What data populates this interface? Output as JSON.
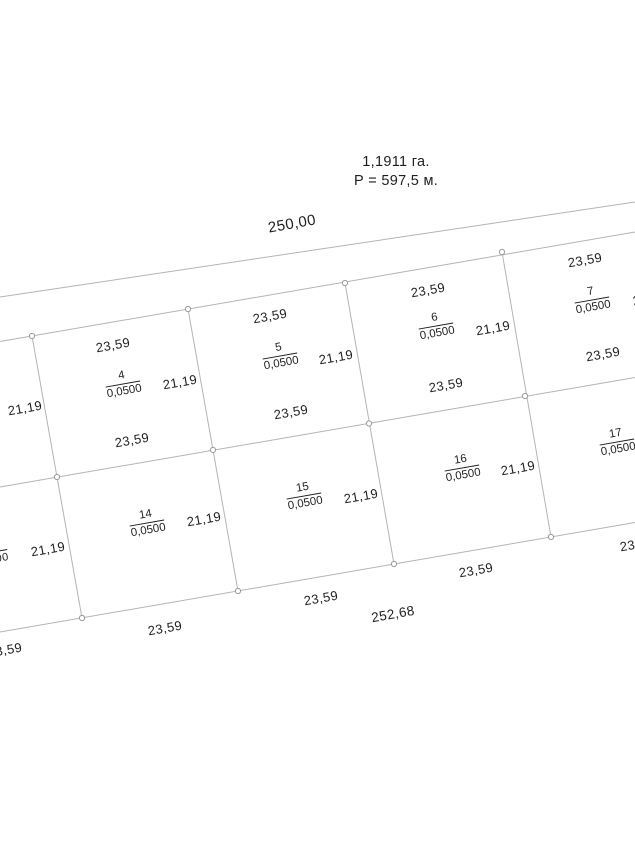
{
  "plan": {
    "area_total": "1,1911 га.",
    "perimeter": "Р = 597,5 м."
  },
  "colors": {
    "boundary_line": "#b4b4b4",
    "marker_stroke": "#9a9a9a",
    "text": "#1f1f1f"
  },
  "dim_labels": [
    {
      "name": "dim-top-total",
      "text": "250,00",
      "x": 292,
      "y": 224,
      "cls": "xl"
    },
    {
      "name": "dim-bottom-total",
      "text": "252,68",
      "x": 393,
      "y": 614,
      "cls": "big"
    },
    {
      "name": "dim-p4-top",
      "text": "23,59",
      "x": 113,
      "y": 345,
      "cls": ""
    },
    {
      "name": "dim-p4-right",
      "text": "21,19",
      "x": 180,
      "y": 382,
      "cls": ""
    },
    {
      "name": "dim-p4-bottom",
      "text": "23,59",
      "x": 132,
      "y": 440,
      "cls": ""
    },
    {
      "name": "dim-p5-top",
      "text": "23,59",
      "x": 270,
      "y": 316,
      "cls": ""
    },
    {
      "name": "dim-p5-right",
      "text": "21,19",
      "x": 336,
      "y": 357,
      "cls": ""
    },
    {
      "name": "dim-p5-bottom",
      "text": "23,59",
      "x": 291,
      "y": 412,
      "cls": ""
    },
    {
      "name": "dim-p6-top",
      "text": "23,59",
      "x": 428,
      "y": 290,
      "cls": ""
    },
    {
      "name": "dim-p6-right",
      "text": "21,19",
      "x": 493,
      "y": 328,
      "cls": ""
    },
    {
      "name": "dim-p6-bottom",
      "text": "23,59",
      "x": 446,
      "y": 385,
      "cls": ""
    },
    {
      "name": "dim-p7-top",
      "text": "23,59",
      "x": 585,
      "y": 260,
      "cls": ""
    },
    {
      "name": "dim-p7-right",
      "text": "21,19",
      "x": 650,
      "y": 298,
      "cls": ""
    },
    {
      "name": "dim-p7-bottom",
      "text": "23,59",
      "x": 603,
      "y": 354,
      "cls": ""
    },
    {
      "name": "dim-p3-right",
      "text": "21,19",
      "x": 25,
      "y": 408,
      "cls": ""
    },
    {
      "name": "dim-p13-right",
      "text": "21,19",
      "x": 48,
      "y": 549,
      "cls": ""
    },
    {
      "name": "dim-p13-bottom",
      "text": "23,59",
      "x": 5,
      "y": 650,
      "cls": ""
    },
    {
      "name": "dim-p13-area-fragment",
      "text": "00",
      "x": 2,
      "y": 557,
      "cls": "frag"
    },
    {
      "name": "dim-p14-right",
      "text": "21,19",
      "x": 204,
      "y": 519,
      "cls": ""
    },
    {
      "name": "dim-p14-bottom",
      "text": "23,59",
      "x": 165,
      "y": 628,
      "cls": ""
    },
    {
      "name": "dim-p15-right",
      "text": "21,19",
      "x": 361,
      "y": 496,
      "cls": ""
    },
    {
      "name": "dim-p15-bottom",
      "text": "23,59",
      "x": 321,
      "y": 598,
      "cls": ""
    },
    {
      "name": "dim-p16-right",
      "text": "21,19",
      "x": 518,
      "y": 468,
      "cls": ""
    },
    {
      "name": "dim-p16-bottom",
      "text": "23,59",
      "x": 476,
      "y": 570,
      "cls": ""
    },
    {
      "name": "dim-p17-bottom",
      "text": "23,59",
      "x": 637,
      "y": 544,
      "cls": ""
    }
  ],
  "parcels": [
    {
      "name": "parcel-4-label",
      "number": "4",
      "area": "0,0500",
      "x": 123,
      "y": 384
    },
    {
      "name": "parcel-5-label",
      "number": "5",
      "area": "0,0500",
      "x": 280,
      "y": 356
    },
    {
      "name": "parcel-6-label",
      "number": "6",
      "area": "0,0500",
      "x": 436,
      "y": 326
    },
    {
      "name": "parcel-7-label",
      "number": "7",
      "area": "0,0500",
      "x": 592,
      "y": 300
    },
    {
      "name": "parcel-14-label",
      "number": "14",
      "area": "0,0500",
      "x": 147,
      "y": 523
    },
    {
      "name": "parcel-15-label",
      "number": "15",
      "area": "0,0500",
      "x": 304,
      "y": 496
    },
    {
      "name": "parcel-16-label",
      "number": "16",
      "area": "0,0500",
      "x": 462,
      "y": 468
    },
    {
      "name": "parcel-17-label",
      "number": "17",
      "area": "0,0500",
      "x": 617,
      "y": 442
    }
  ]
}
